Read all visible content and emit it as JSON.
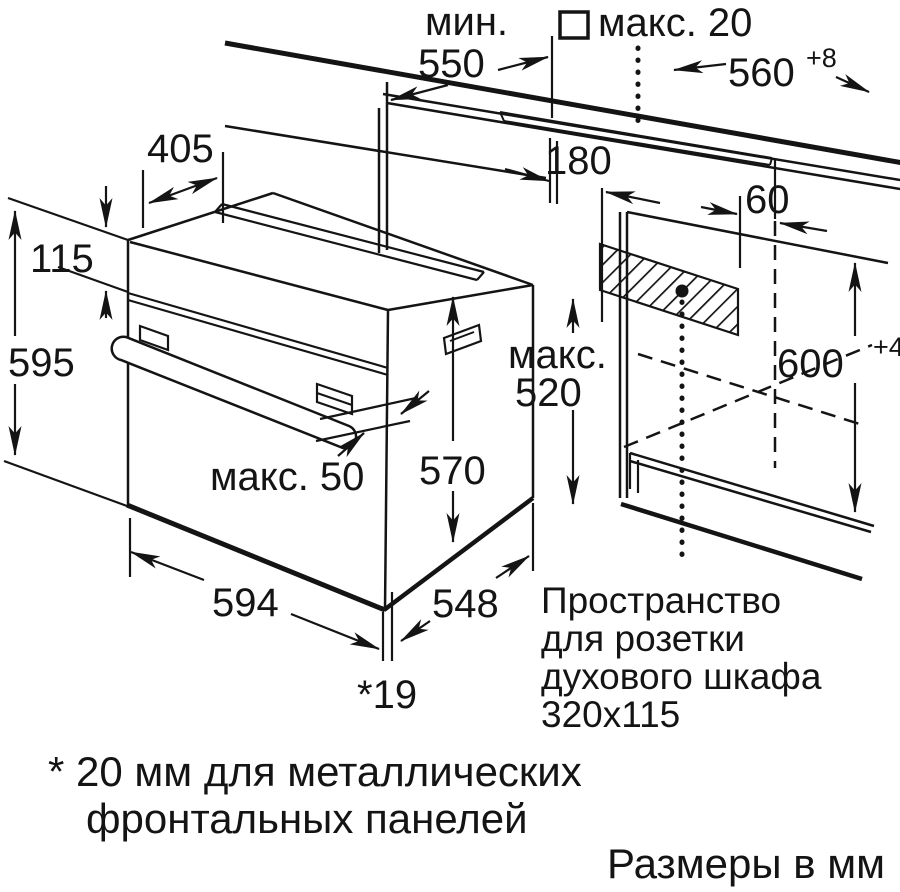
{
  "page": {
    "background": "#ffffff",
    "line_color": "#141414",
    "type": "appliance-installation-drawing",
    "subject": "built-in-oven-niche-dimensions"
  },
  "labels": {
    "min_prefix": "мин.",
    "min_value": "550",
    "front_overhang": "макс. 20",
    "niche_width": "560",
    "niche_width_tol": "+8",
    "top_depth": "405",
    "panel_height": "115",
    "oven_height": "595",
    "socket_left_offset": "180",
    "socket_right_offset": "60",
    "max_label": "макс.",
    "max_depth_value": "520",
    "niche_height": "600",
    "niche_height_tol": "+4",
    "body_depth": "570",
    "handle_clearance": "макс. 50",
    "oven_width": "594",
    "body_rear_depth": "548",
    "door_panel_thickness": "*19",
    "socket_note_1": "Пространство",
    "socket_note_2": "для розетки",
    "socket_note_3": "духового шкафа",
    "socket_note_4": "320x115",
    "footnote_1": "* 20 мм для металлических",
    "footnote_2": "фронтальных панелей",
    "units_note": "Размеры в мм"
  }
}
